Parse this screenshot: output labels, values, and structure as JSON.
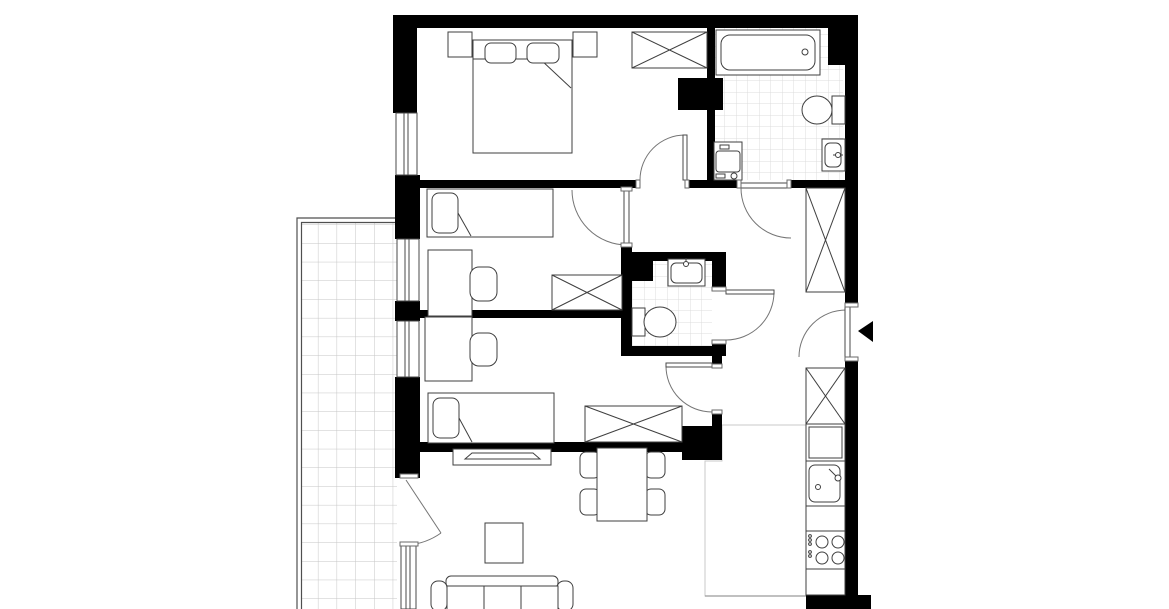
{
  "plan": {
    "type": "apartment-floor-plan",
    "style": "black-and-white architectural drawing, top-down view, no text labels",
    "colors": {
      "walls": "#000000",
      "background": "#ffffff",
      "furniture_outline": "#3f3f3f",
      "door_arc": "#757575",
      "tile_grid_small": "#dcdcdc",
      "tile_grid_balcony": "#c5c5c5",
      "entrance_marker": "#000000"
    },
    "rooms": [
      {
        "name": "bedroom-1",
        "position": "top-left",
        "furniture": [
          "double-bed",
          "pillow-left",
          "pillow-right",
          "nightstand-left",
          "nightstand-right",
          "wardrobe-x"
        ],
        "window": "left wall",
        "door": "opens inward from hallway"
      },
      {
        "name": "bathroom",
        "position": "top-right",
        "tiled": true,
        "furniture": [
          "bathtub",
          "toilet",
          "washbasin",
          "washing-machine"
        ],
        "door": "opens to hallway"
      },
      {
        "name": "bedroom-2",
        "position": "middle-left",
        "furniture": [
          "single-bed",
          "desk",
          "chair",
          "wardrobe-x"
        ],
        "window": "left wall",
        "door": "opens inward from hallway"
      },
      {
        "name": "wc",
        "position": "center",
        "tiled": true,
        "furniture": [
          "washbasin",
          "toilet"
        ],
        "door": "opens to hallway"
      },
      {
        "name": "bedroom-3",
        "position": "lower-left",
        "furniture": [
          "single-bed",
          "desk",
          "chair",
          "wardrobe-x"
        ],
        "window": "left wall",
        "door": "opens inward from corridor"
      },
      {
        "name": "hallway",
        "position": "right",
        "furniture": [
          "wardrobe-x-upper",
          "wardrobe-x-lower"
        ],
        "entrance": "right wall with black triangle marker pointing left"
      },
      {
        "name": "kitchen",
        "position": "bottom-right",
        "tiled": true,
        "furniture": [
          "tall-cabinet-x",
          "base-cabinet",
          "kitchen-sink",
          "countertop",
          "cooktop-four-burners",
          "countertop-2"
        ]
      },
      {
        "name": "living-dining-room",
        "position": "bottom",
        "furniture": [
          "tv-sideboard",
          "tv",
          "dining-table",
          "chair-1",
          "chair-2",
          "chair-3",
          "chair-4",
          "coffee-table",
          "sofa-three-seat"
        ],
        "balcony_door": "left wall, partly open"
      },
      {
        "name": "balcony",
        "position": "left",
        "tiled": true,
        "furniture": []
      }
    ],
    "doors": [
      {
        "name": "bedroom-1-door",
        "swing": "into bedroom 1"
      },
      {
        "name": "bedroom-2-door",
        "swing": "into bedroom 2"
      },
      {
        "name": "bathroom-door",
        "swing": "into hallway"
      },
      {
        "name": "wc-door",
        "swing": "into hallway"
      },
      {
        "name": "bedroom-3-door",
        "swing": "into bedroom 3"
      },
      {
        "name": "entrance-door",
        "swing": "into hallway",
        "marker": "black triangle pointing left"
      },
      {
        "name": "balcony-door",
        "swing": "into living room, drawn ajar"
      }
    ]
  }
}
